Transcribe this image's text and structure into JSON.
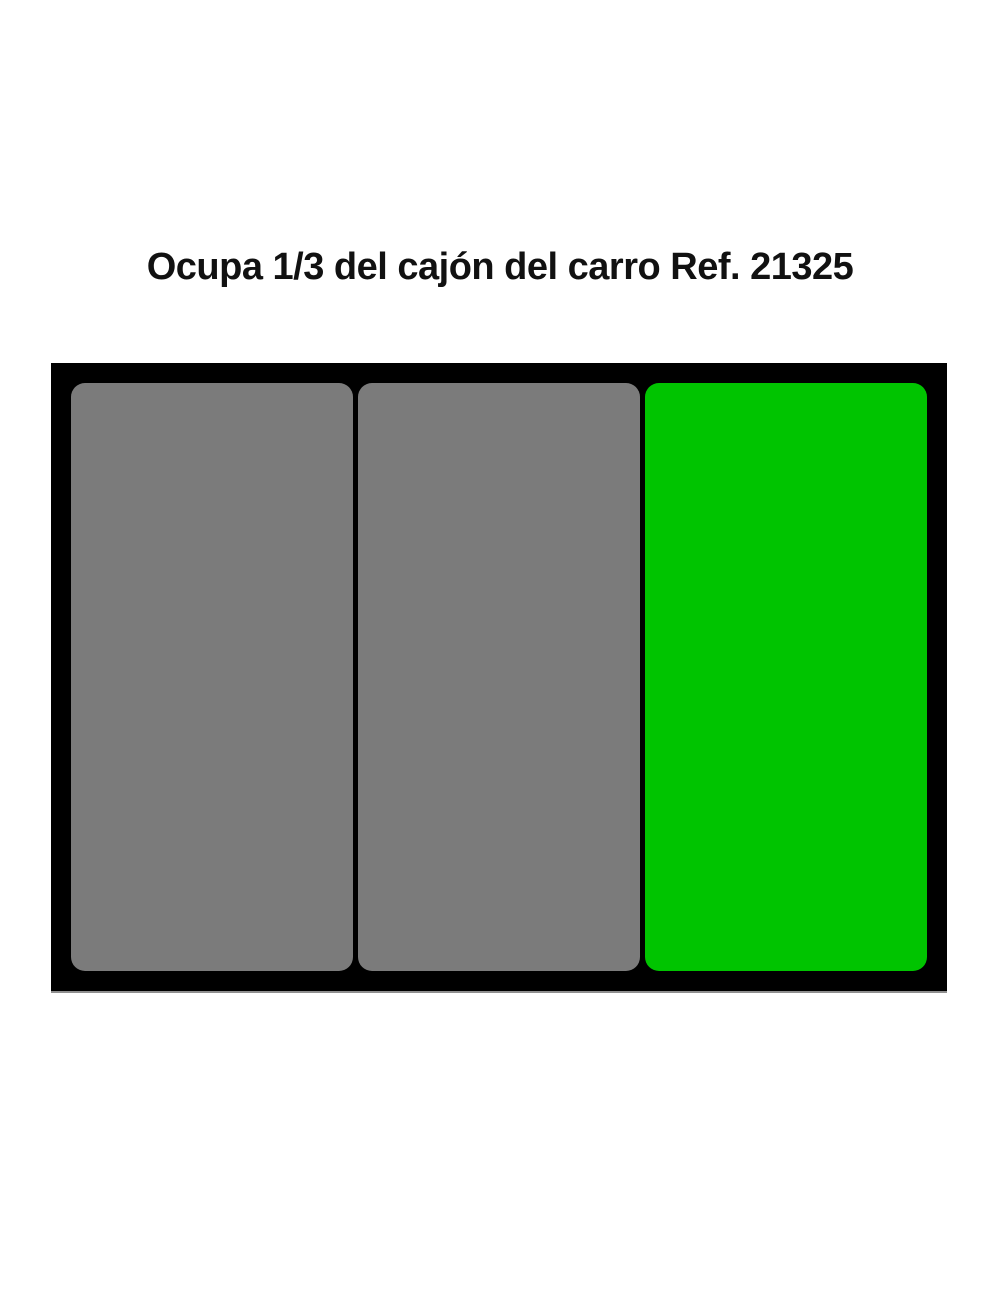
{
  "page": {
    "title": "Ocupa 1/3 del cajón del carro Ref. 21325",
    "background_color": "#ffffff",
    "title_color": "#111111"
  },
  "drawer": {
    "frame_color": "#000000",
    "slot_count": 3,
    "highlight_color": "#00c400",
    "slots": [
      {
        "position": 1,
        "color": "#7b7b7b"
      },
      {
        "position": 2,
        "color": "#7b7b7b"
      },
      {
        "position": 3,
        "color": "#00c400"
      }
    ]
  }
}
